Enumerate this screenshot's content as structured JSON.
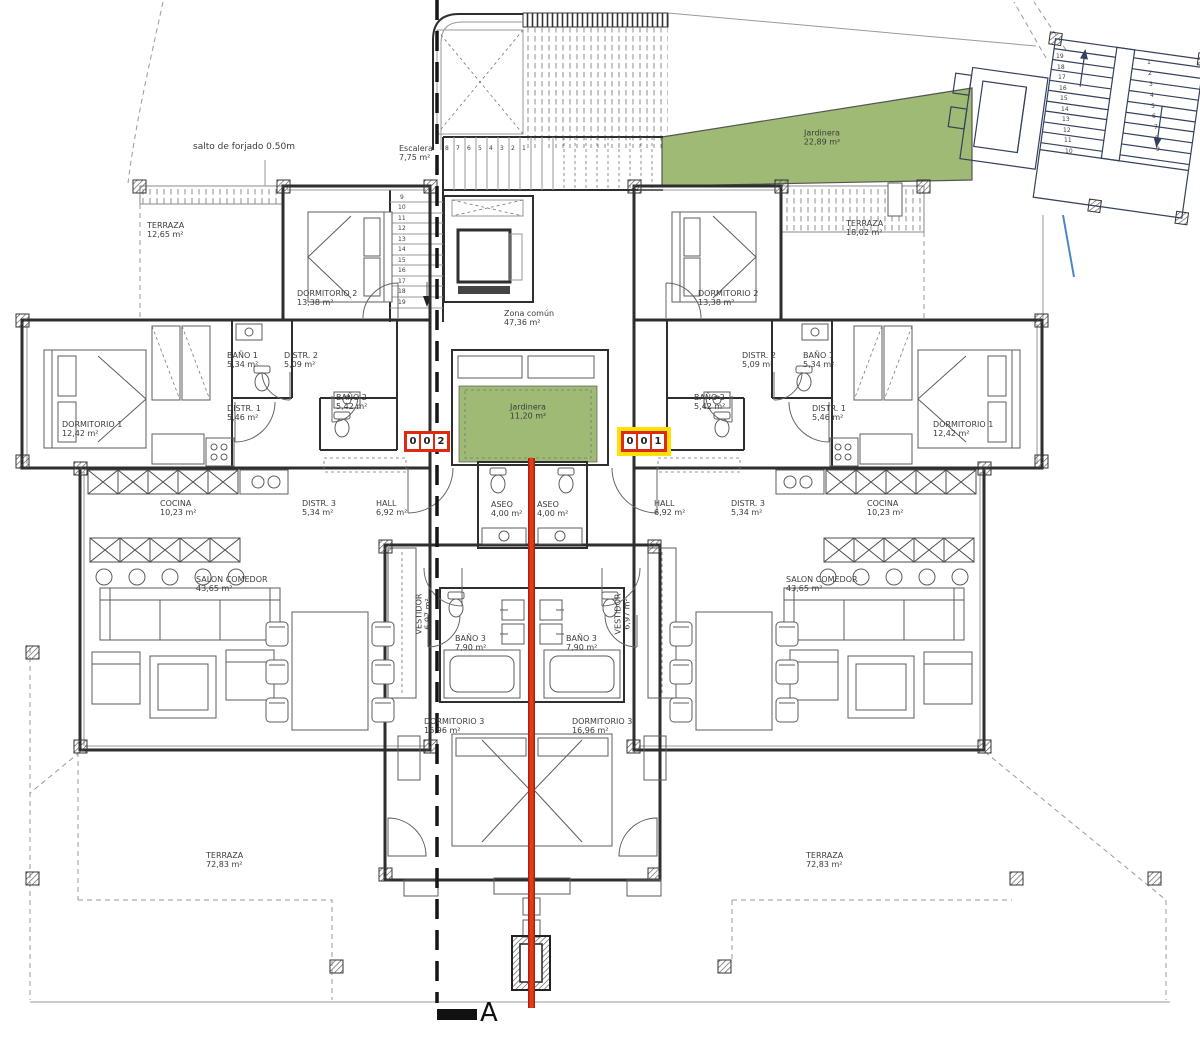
{
  "colors": {
    "garden": "#9eba74",
    "section-red": "#e8391c",
    "section-red-dark": "#a82508",
    "badge-red": "#dd2b12",
    "badge-yellow": "#ffe10a",
    "blue-line": "#4a86c8",
    "navy": "#33415c"
  },
  "units": {
    "left": {
      "number": "002",
      "digits": [
        "0",
        "0",
        "2"
      ]
    },
    "right": {
      "number": "001",
      "digits": [
        "0",
        "0",
        "1"
      ]
    }
  },
  "section": {
    "letter": "A"
  },
  "labels": [
    {
      "n": "note-salto-forjado",
      "t": "salto de forjado 0.50m",
      "x": 193,
      "y": 142,
      "s": 9
    },
    {
      "n": "room-label-terraza-nw",
      "t": "TERRAZA\n12,65 m²",
      "x": 147,
      "y": 221
    },
    {
      "n": "room-label-escalera",
      "t": "Escalera\n7,75 m²",
      "x": 399,
      "y": 144
    },
    {
      "n": "room-label-dormitorio2-left",
      "t": "DORMITORIO 2\n13,38 m²",
      "x": 297,
      "y": 289
    },
    {
      "n": "room-label-jardinera-roof",
      "t": "Jardinera\n22,89 m²",
      "x": 822,
      "y": 138,
      "a": "center"
    },
    {
      "n": "room-label-terraza-ne",
      "t": "TERRAZA\n18,02 m²",
      "x": 846,
      "y": 219
    },
    {
      "n": "room-label-dormitorio2-right",
      "t": "DORMITORIO 2\n13,38 m²",
      "x": 698,
      "y": 289
    },
    {
      "n": "room-label-zona-comun",
      "t": "Zona común\n47,36 m²",
      "x": 504,
      "y": 309
    },
    {
      "n": "room-label-bano1-left",
      "t": "BAÑO 1\n5,34 m²",
      "x": 227,
      "y": 351
    },
    {
      "n": "room-label-distr2-left",
      "t": "DISTR. 2\n5,09 m²",
      "x": 284,
      "y": 351
    },
    {
      "n": "room-label-bano2-left",
      "t": "BAÑO 2\n5,42 m²",
      "x": 336,
      "y": 393
    },
    {
      "n": "room-label-distr1-left",
      "t": "DISTR. 1\n5,46 m²",
      "x": 227,
      "y": 404
    },
    {
      "n": "room-label-dormitorio1-left",
      "t": "DORMITORIO 1\n12,42 m²",
      "x": 62,
      "y": 420
    },
    {
      "n": "room-label-bano1-right",
      "t": "BAÑO 1\n5,34 m²",
      "x": 803,
      "y": 351
    },
    {
      "n": "room-label-distr2-right",
      "t": "DISTR. 2\n5,09 m²",
      "x": 742,
      "y": 351
    },
    {
      "n": "room-label-bano2-right",
      "t": "BAÑO 2\n5,42 m²",
      "x": 694,
      "y": 393
    },
    {
      "n": "room-label-distr1-right",
      "t": "DISTR. 1\n5,46 m²",
      "x": 812,
      "y": 404
    },
    {
      "n": "room-label-dormitorio1-right",
      "t": "DORMITORIO 1\n12,42 m²",
      "x": 933,
      "y": 420
    },
    {
      "n": "room-label-jardinera-patio",
      "t": "Jardinera\n11,20 m²",
      "x": 528,
      "y": 412,
      "a": "center"
    },
    {
      "n": "room-label-cocina-left",
      "t": "COCINA\n10,23 m²",
      "x": 160,
      "y": 499
    },
    {
      "n": "room-label-distr3-left",
      "t": "DISTR. 3\n5,34 m²",
      "x": 302,
      "y": 499
    },
    {
      "n": "room-label-hall-left",
      "t": "HALL\n6,92 m²",
      "x": 376,
      "y": 499
    },
    {
      "n": "room-label-aseo-left",
      "t": "ASEO\n4,00 m²",
      "x": 491,
      "y": 500
    },
    {
      "n": "room-label-aseo-right",
      "t": "ASEO\n4,00 m²",
      "x": 537,
      "y": 500
    },
    {
      "n": "room-label-hall-right",
      "t": "HALL\n6,92 m²",
      "x": 654,
      "y": 499
    },
    {
      "n": "room-label-distr3-right",
      "t": "DISTR. 3\n5,34 m²",
      "x": 731,
      "y": 499
    },
    {
      "n": "room-label-cocina-right",
      "t": "COCINA\n10,23 m²",
      "x": 867,
      "y": 499
    },
    {
      "n": "room-label-salon-left",
      "t": "SALON COMEDOR\n43,65 m²",
      "x": 196,
      "y": 575
    },
    {
      "n": "room-label-salon-right",
      "t": "SALON COMEDOR\n43,65 m²",
      "x": 786,
      "y": 575
    },
    {
      "n": "room-label-vestidor-left",
      "t": "VESTIDOR\n6,97 m²",
      "x": 424,
      "y": 614,
      "a": "center",
      "r": -90
    },
    {
      "n": "room-label-vestidor-right",
      "t": "VESTIDOR\n6,97 m²",
      "x": 623,
      "y": 614,
      "a": "center",
      "r": -90
    },
    {
      "n": "room-label-bano3-left",
      "t": "BAÑO 3\n7,90 m²",
      "x": 455,
      "y": 634
    },
    {
      "n": "room-label-bano3-right",
      "t": "BAÑO 3\n7,90 m²",
      "x": 566,
      "y": 634
    },
    {
      "n": "room-label-dormitorio3-left",
      "t": "DORMITORIO 3\n16,96 m²",
      "x": 424,
      "y": 717
    },
    {
      "n": "room-label-dormitorio3-right",
      "t": "DORMITORIO 3\n16,96 m²",
      "x": 572,
      "y": 717
    },
    {
      "n": "room-label-terraza-sw",
      "t": "TERRAZA\n72,83 m²",
      "x": 206,
      "y": 851
    },
    {
      "n": "room-label-terraza-se",
      "t": "TERRAZA\n72,83 m²",
      "x": 806,
      "y": 851
    },
    {
      "n": "section-letter",
      "t": "A",
      "x": 480,
      "y": 998,
      "s": 26,
      "c": "#111111"
    },
    {
      "n": "stair-step-number",
      "t": "8",
      "x": 445,
      "y": 145,
      "s": 6
    },
    {
      "n": "stair-step-number",
      "t": "7",
      "x": 456,
      "y": 145,
      "s": 6
    },
    {
      "n": "stair-step-number",
      "t": "6",
      "x": 467,
      "y": 145,
      "s": 6
    },
    {
      "n": "stair-step-number",
      "t": "5",
      "x": 478,
      "y": 145,
      "s": 6
    },
    {
      "n": "stair-step-number",
      "t": "4",
      "x": 489,
      "y": 145,
      "s": 6
    },
    {
      "n": "stair-step-number",
      "t": "3",
      "x": 500,
      "y": 145,
      "s": 6
    },
    {
      "n": "stair-step-number",
      "t": "2",
      "x": 511,
      "y": 145,
      "s": 6
    },
    {
      "n": "stair-step-number",
      "t": "1",
      "x": 522,
      "y": 145,
      "s": 6
    },
    {
      "n": "stair-step-number",
      "t": "9",
      "x": 400,
      "y": 194,
      "s": 6
    },
    {
      "n": "stair-step-number",
      "t": "10",
      "x": 398,
      "y": 204,
      "s": 6
    },
    {
      "n": "stair-step-number",
      "t": "11",
      "x": 398,
      "y": 215,
      "s": 6
    },
    {
      "n": "stair-step-number",
      "t": "12",
      "x": 398,
      "y": 225,
      "s": 6
    },
    {
      "n": "stair-step-number",
      "t": "13",
      "x": 398,
      "y": 236,
      "s": 6
    },
    {
      "n": "stair-step-number",
      "t": "14",
      "x": 398,
      "y": 246,
      "s": 6
    },
    {
      "n": "stair-step-number",
      "t": "15",
      "x": 398,
      "y": 257,
      "s": 6
    },
    {
      "n": "stair-step-number",
      "t": "16",
      "x": 398,
      "y": 267,
      "s": 6
    },
    {
      "n": "stair-step-number",
      "t": "17",
      "x": 398,
      "y": 278,
      "s": 6
    },
    {
      "n": "stair-step-number",
      "t": "18",
      "x": 398,
      "y": 288,
      "s": 6
    },
    {
      "n": "stair-step-number",
      "t": "19",
      "x": 398,
      "y": 299,
      "s": 6
    },
    {
      "n": "stair-step-number",
      "t": "19",
      "x": 1056,
      "y": 53,
      "s": 6
    },
    {
      "n": "stair-step-number",
      "t": "18",
      "x": 1057,
      "y": 64,
      "s": 6
    },
    {
      "n": "stair-step-number",
      "t": "17",
      "x": 1058,
      "y": 74,
      "s": 6
    },
    {
      "n": "stair-step-number",
      "t": "16",
      "x": 1059,
      "y": 85,
      "s": 6
    },
    {
      "n": "stair-step-number",
      "t": "15",
      "x": 1060,
      "y": 95,
      "s": 6
    },
    {
      "n": "stair-step-number",
      "t": "14",
      "x": 1061,
      "y": 106,
      "s": 6
    },
    {
      "n": "stair-step-number",
      "t": "13",
      "x": 1062,
      "y": 116,
      "s": 6
    },
    {
      "n": "stair-step-number",
      "t": "12",
      "x": 1063,
      "y": 127,
      "s": 6
    },
    {
      "n": "stair-step-number",
      "t": "11",
      "x": 1064,
      "y": 137,
      "s": 6
    },
    {
      "n": "stair-step-number",
      "t": "10",
      "x": 1065,
      "y": 148,
      "s": 6
    },
    {
      "n": "stair-step-number",
      "t": "1",
      "x": 1147,
      "y": 59,
      "s": 6
    },
    {
      "n": "stair-step-number",
      "t": "2",
      "x": 1148,
      "y": 70,
      "s": 6
    },
    {
      "n": "stair-step-number",
      "t": "3",
      "x": 1149,
      "y": 81,
      "s": 6
    },
    {
      "n": "stair-step-number",
      "t": "4",
      "x": 1150,
      "y": 92,
      "s": 6
    },
    {
      "n": "stair-step-number",
      "t": "5",
      "x": 1151,
      "y": 103,
      "s": 6
    },
    {
      "n": "stair-step-number",
      "t": "6",
      "x": 1152,
      "y": 113,
      "s": 6
    },
    {
      "n": "stair-step-number",
      "t": "7",
      "x": 1154,
      "y": 124,
      "s": 6
    },
    {
      "n": "stair-step-number",
      "t": "8",
      "x": 1155,
      "y": 135,
      "s": 6
    },
    {
      "n": "stair-step-number",
      "t": "9",
      "x": 1156,
      "y": 146,
      "s": 6
    }
  ]
}
